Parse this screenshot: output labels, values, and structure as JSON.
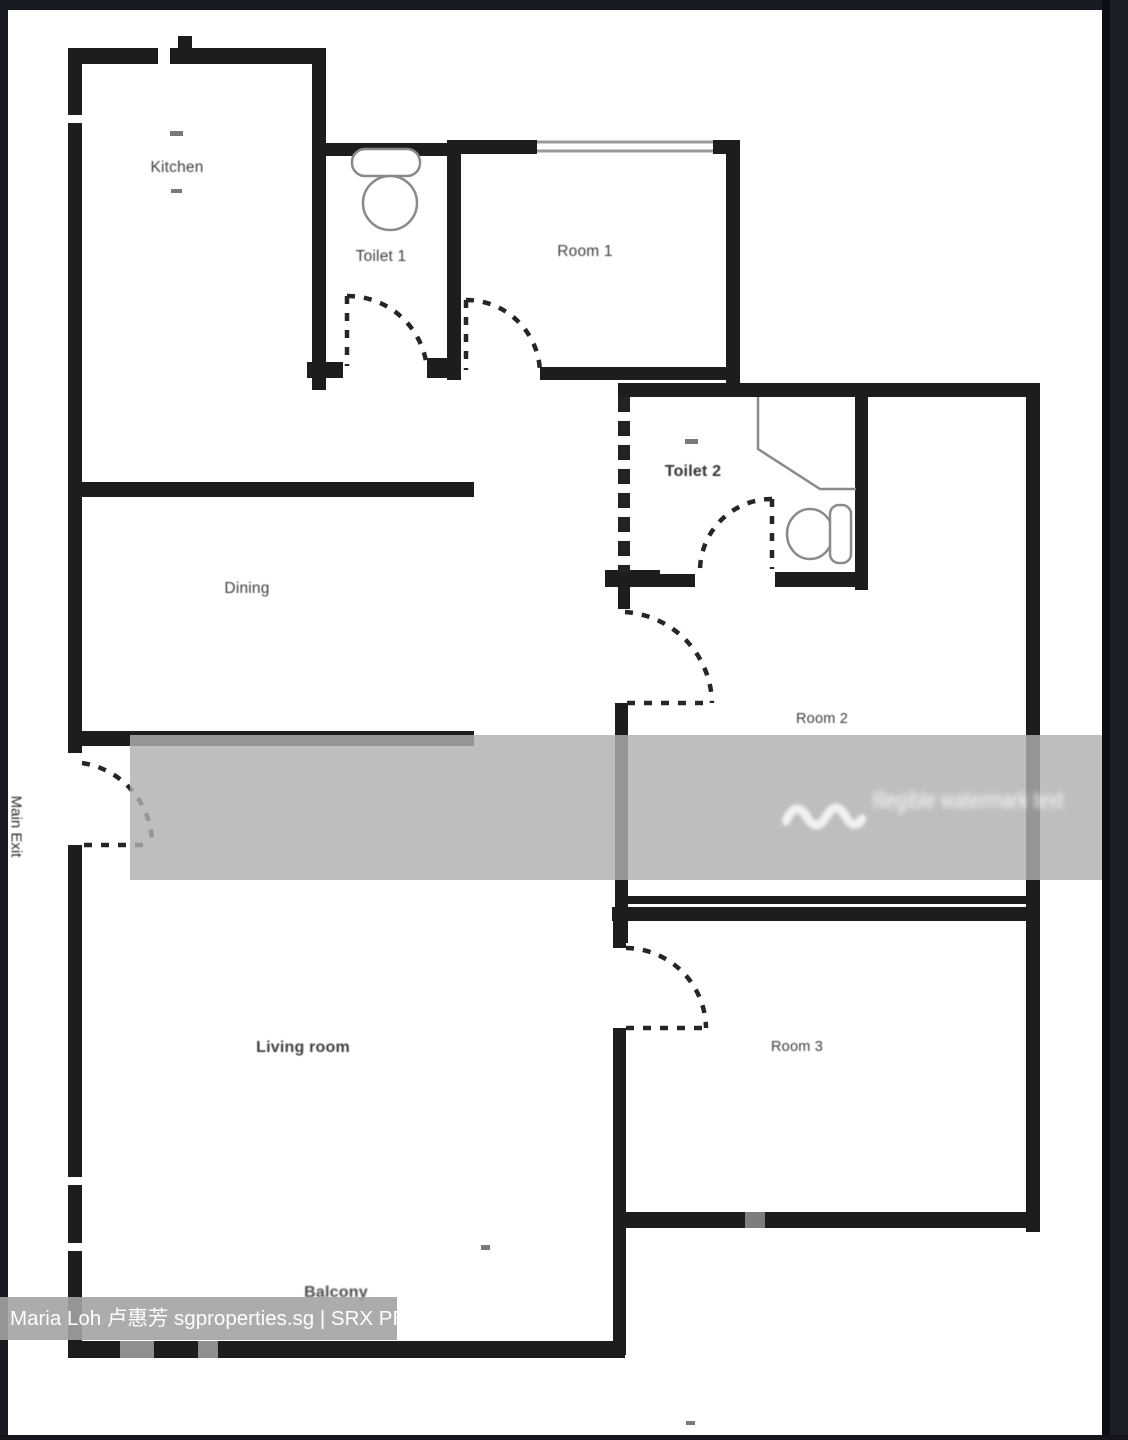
{
  "image_type": "apartment-floor-plan",
  "plan": {
    "rooms": {
      "kitchen": {
        "label": "Kitchen"
      },
      "toilet1": {
        "label": "Toilet 1"
      },
      "room1": {
        "label": "Room 1"
      },
      "toilet2": {
        "label": "Toilet 2"
      },
      "dining": {
        "label": "Dining"
      },
      "room2": {
        "label": "Room 2"
      },
      "living_room": {
        "label": "Living room"
      },
      "room3": {
        "label": "Room 3"
      },
      "balcony": {
        "label": "Balcony"
      },
      "main_exit": {
        "label": "Main Exit"
      }
    },
    "fixtures": [
      "toilet1-sink",
      "toilet1-bowl",
      "toilet2-shower",
      "toilet2-bowl",
      "toilet2-cistern"
    ],
    "colors": {
      "wall": "#1d1d1d",
      "floor": "#ffffff",
      "frame_background": "#171a20",
      "fixture_outline": "#8a8a8a",
      "watermark_band": "#b0b0b0",
      "caption_band": "#a3a3a3",
      "label_text": "#3f3f3f",
      "caption_text": "#ffffff"
    }
  },
  "watermark": {
    "logo": "double-wave-icon",
    "text": "Illegible watermark text",
    "legible": false
  },
  "caption": {
    "text": "Maria Loh 卢惠芳 sgproperties.sg | SRX PROPERTY"
  }
}
